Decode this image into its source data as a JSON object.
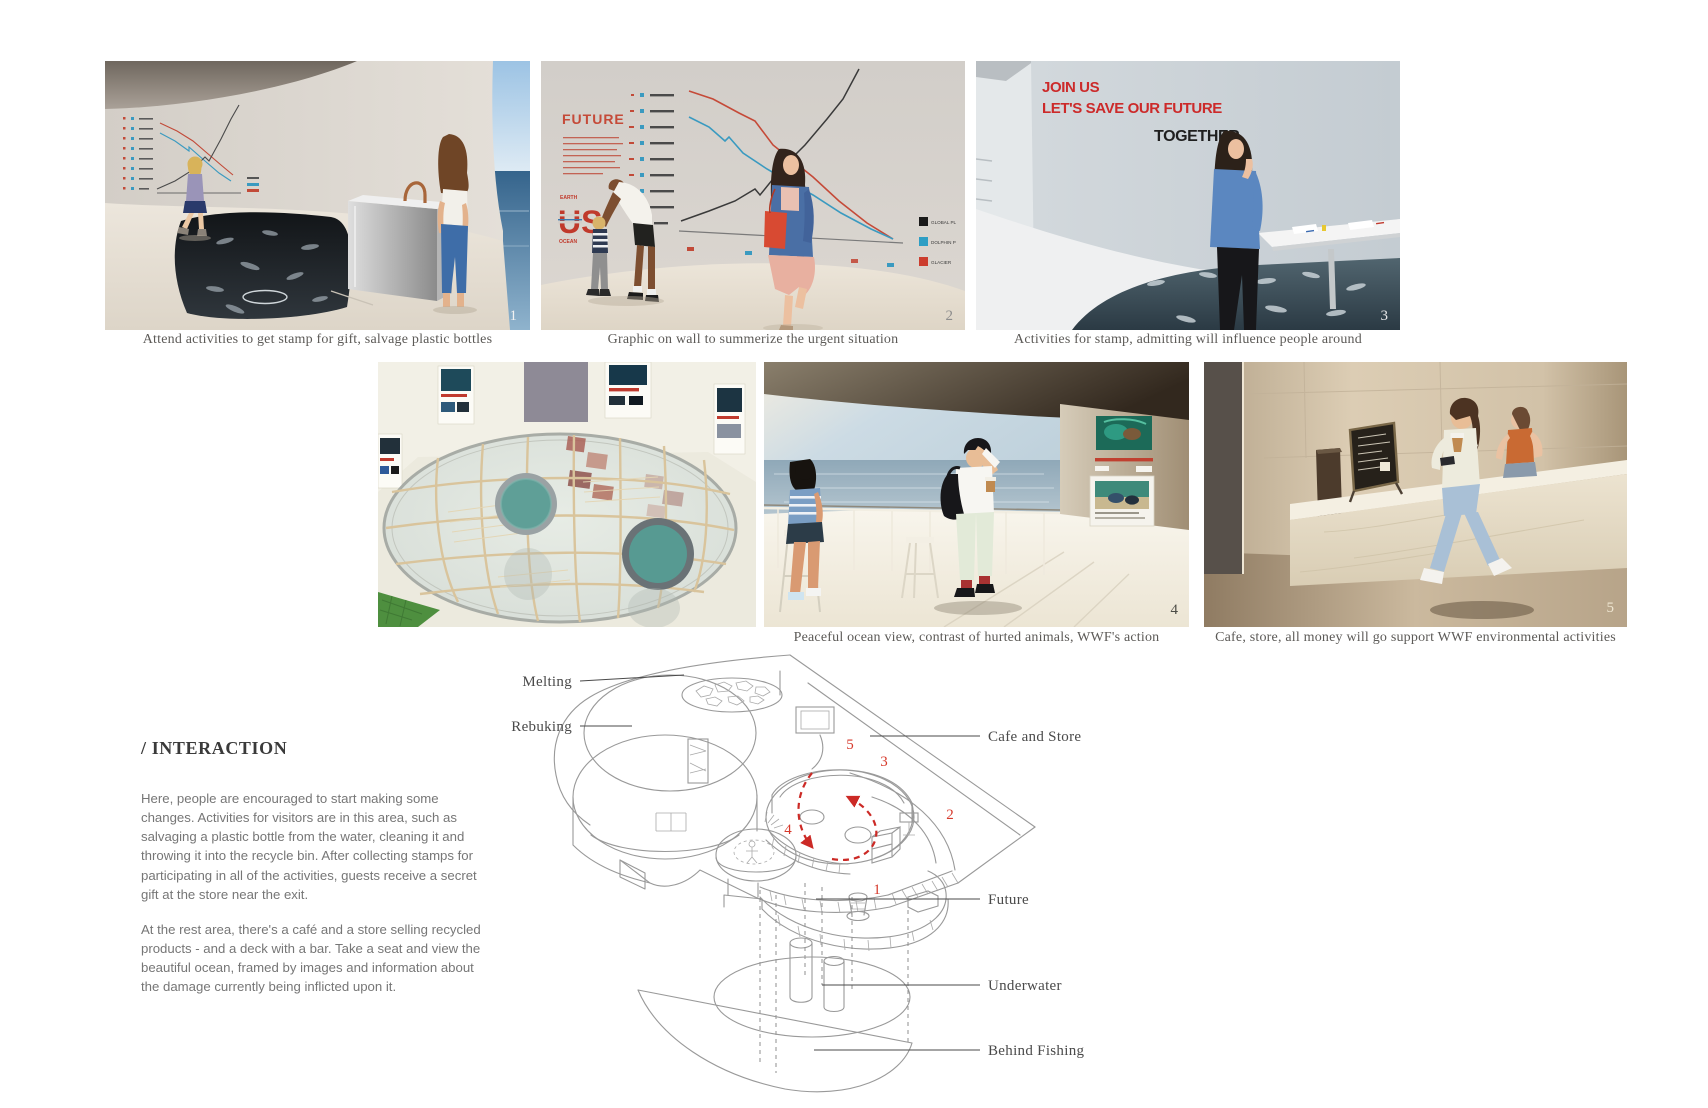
{
  "palette": {
    "accent_red": "#c8372d",
    "diagram_red": "#d63a2c",
    "caption_gray": "#5c5a57",
    "body_gray": "#767676",
    "label_gray": "#4a4a4a"
  },
  "figures": {
    "f1": {
      "badge": "1",
      "caption": "Attend activities to get stamp for gift, salvage plastic bottles"
    },
    "f2": {
      "badge": "2",
      "caption": "Graphic on wall to summerize the urgent situation",
      "wall_title": "FUTURE",
      "logo_top": "EARTH",
      "logo_main": "US",
      "logo_bottom": "OCEAN",
      "legend": [
        {
          "label": "GLOBAL PL",
          "color": "#1a1a1a"
        },
        {
          "label": "DOLPHIN P",
          "color": "#2e9ec4"
        },
        {
          "label": "GLACIER",
          "color": "#cc3d2e"
        }
      ]
    },
    "f3": {
      "badge": "3",
      "caption": "Activities for stamp, admitting will influence people around",
      "wall_line1": "JOIN US",
      "wall_line2": "LET'S SAVE OUR FUTURE",
      "wall_line3": "TOGETHER"
    },
    "f4": {
      "badge": ""
    },
    "f5": {
      "badge": "4",
      "caption": "Peaceful ocean view, contrast of hurted animals, WWF's action"
    },
    "f6": {
      "badge": "5",
      "caption": "Cafe, store, all money will go support WWF environmental activities"
    }
  },
  "interaction": {
    "heading": "/ INTERACTION",
    "para1": "Here, people are encouraged to start making some changes. Activities for visitors are in this area, such as salvaging a plastic bottle from the water, cleaning it and throwing it into the recycle bin. After collecting stamps for participating in all of the activities, guests receive a secret gift at the store near the exit.",
    "para2": "At the rest area, there's a café and a store selling recycled products - and a deck with a bar. Take a seat and view the beautiful ocean, framed by images and information about the damage currently being inflicted upon it."
  },
  "diagram": {
    "labels": {
      "melting": "Melting",
      "rebuking": "Rebuking",
      "cafe": "Cafe and Store",
      "future": "Future",
      "underwater": "Underwater",
      "behind_fishing": "Behind Fishing"
    },
    "numbers": {
      "n1": "1",
      "n2": "2",
      "n3": "3",
      "n4": "4",
      "n5": "5"
    }
  }
}
